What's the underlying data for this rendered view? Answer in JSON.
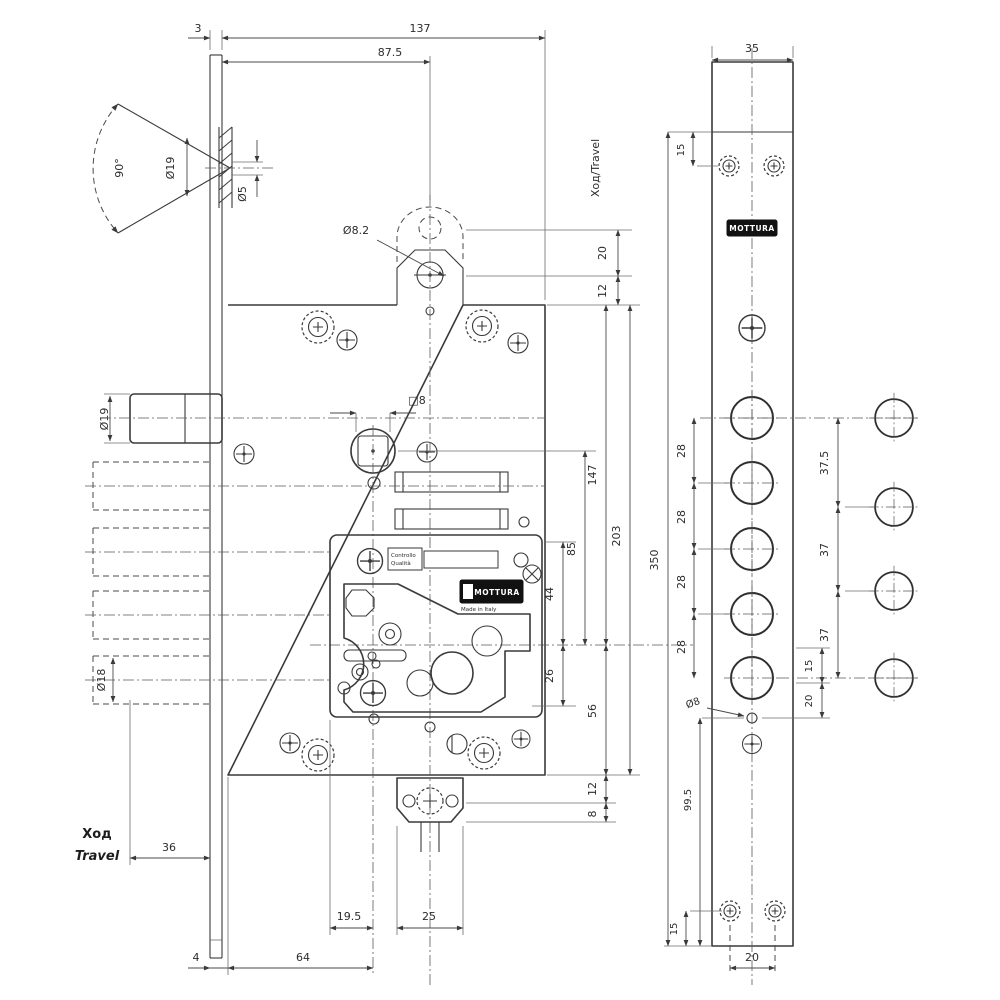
{
  "side_view": {
    "top_dims": {
      "plate_thickness": "3",
      "body_depth": "137",
      "latch_backset": "87.5"
    },
    "countersink": {
      "angle": "90°",
      "outer_dia": "Ø19",
      "hole_dia": "Ø5"
    },
    "aux_bolt": {
      "dia": "Ø8.2",
      "travel_label": "Ход/Travel",
      "travel": "20",
      "offset": "12"
    },
    "spindle": {
      "square": "□8"
    },
    "latch": {
      "dia": "Ø19"
    },
    "deadbolt": {
      "dia": "Ø18"
    },
    "right_dims": {
      "d147": "147",
      "d203": "203",
      "d85": "85",
      "d44": "44",
      "d26": "26",
      "d56": "56",
      "d12": "12",
      "d8": "8"
    },
    "bottom_dims": {
      "throw": "36",
      "hod": "Ход",
      "travel": "Travel",
      "d4": "4",
      "backset": "64",
      "d195": "19.5",
      "d25": "25"
    },
    "cover_plate": {
      "stamp_line1": "Controllo",
      "stamp_line2": "Qualità",
      "brand": "MOTTURA",
      "made": "Made in Italy"
    }
  },
  "front_view": {
    "width": "35",
    "top_screw_offset": "15",
    "brand": "MOTTURA",
    "bolt_spacing": [
      "28",
      "28",
      "28",
      "28"
    ],
    "length": "350",
    "right_dims": {
      "d375": "37.5",
      "d37a": "37",
      "d37b": "37"
    },
    "mid_dims": {
      "d15": "15",
      "d20": "20",
      "hole_dia": "Ø8"
    },
    "lower_dims": {
      "d995": "99.5",
      "d15": "15",
      "d20": "20"
    }
  }
}
